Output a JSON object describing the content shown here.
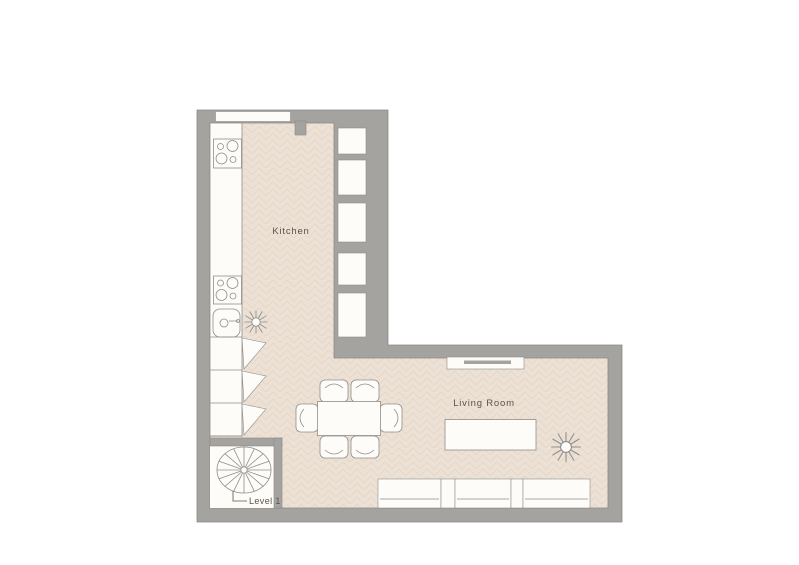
{
  "diagram": {
    "type": "floor-plan",
    "level_label": "Level 1",
    "rooms": [
      {
        "name": "Kitchen",
        "features": [
          "cooktop-upper",
          "countertop",
          "cooktop-lower",
          "sink",
          "potted-plant",
          "base-cabinets-doors-open",
          "wall-niches-x5",
          "window"
        ]
      },
      {
        "name": "Living Room",
        "features": [
          "tv-console",
          "dining-table",
          "dining-chairs-x6",
          "coffee-table",
          "sofa-3-sections",
          "potted-plant",
          "spiral-staircase"
        ]
      }
    ],
    "colors": {
      "wall": "#a5a3a0",
      "wall_outline": "#8b8987",
      "floor": "#ece1d4",
      "floor_pattern": "#ddcfc0",
      "furniture_fill": "#fdfcf8",
      "furniture_outline": "#908e8b",
      "label_text": "#5b544b",
      "background": "#ffffff"
    }
  }
}
